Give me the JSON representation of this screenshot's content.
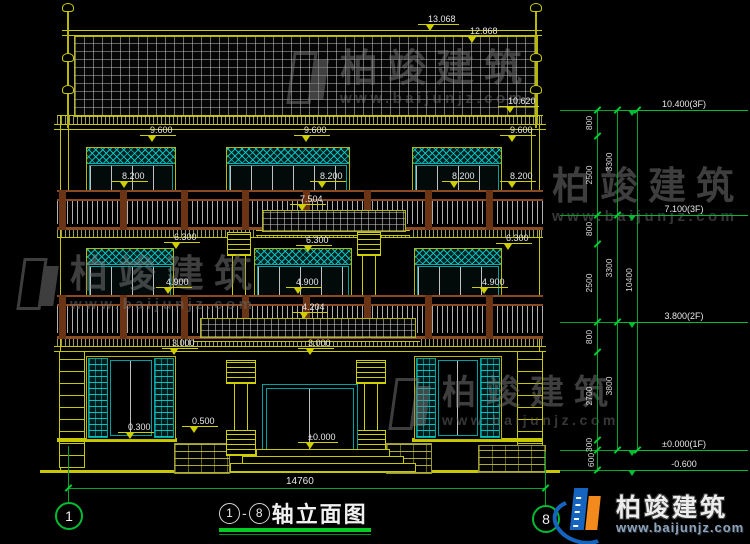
{
  "drawing": {
    "elevation_labels": {
      "v13068": "13.068",
      "v12868": "12.868",
      "v10620": "10.620",
      "v9600": "9.600",
      "v8200": "8.200",
      "v7504": "7.504",
      "v6300": "6.300",
      "v4900": "4.900",
      "v4204": "4.204",
      "v3000": "3.000",
      "v0300": "0.300",
      "v0500": "0.500",
      "v0000": "±0.000"
    },
    "width_dim": "14760",
    "axis_left": "1",
    "axis_right": "8"
  },
  "right_dims": {
    "level_top": "10.400(3F)",
    "level_3f": "7.100(3F)",
    "level_2f": "3.800(2F)",
    "level_1f": "±0.000(1F)",
    "level_ground": "-0.600",
    "seg_800": "800",
    "seg_2500": "2500",
    "seg_2700": "2700",
    "seg_300": "300",
    "seg_600": "600",
    "story_3300": "3300",
    "story_3800": "3800",
    "total": "10400"
  },
  "title": {
    "axis_start": "1",
    "axis_end": "8",
    "dash": "-",
    "text": "轴立面图"
  },
  "logo": {
    "name": "柏竣建筑",
    "url": "www.baijunjz.com"
  },
  "watermark": {
    "name": "柏竣建筑",
    "url": "www.baijunjz.com"
  },
  "colors": {
    "line_yellow": "#c8c800",
    "dim_green": "#00bb33",
    "frame_cyan": "#00b0b0",
    "rail_brown": "#8a4a22",
    "logo_blue": "#1565c0",
    "logo_orange": "#f28a1e",
    "background": "#000000"
  }
}
